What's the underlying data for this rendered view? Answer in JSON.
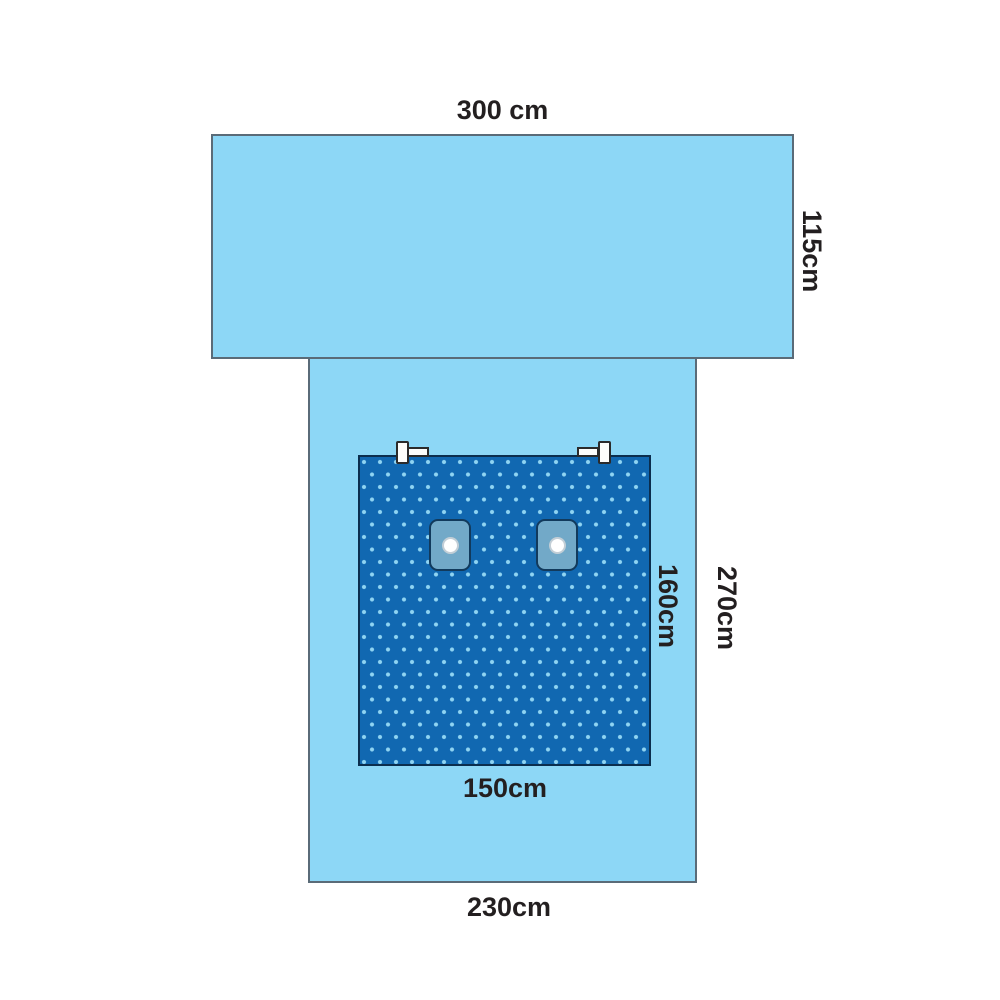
{
  "diagram": {
    "title": "Surgical drape dimension diagram",
    "dimensions": {
      "top_sheet_width": {
        "label": "300 cm"
      },
      "top_sheet_height": {
        "label": "115cm"
      },
      "body_sheet_height": {
        "label": "270cm"
      },
      "panel_height": {
        "label": "160cm"
      },
      "panel_width": {
        "label": "150cm"
      },
      "body_sheet_width": {
        "label": "230cm"
      }
    },
    "parts": {
      "top_sheet": "top cross sheet",
      "body_sheet": "vertical body sheet",
      "panel": "reinforced dotted panel",
      "patches": [
        "fenestration patch left",
        "fenestration patch right"
      ],
      "clips": [
        "tube holder clip left",
        "tube holder clip right"
      ]
    },
    "colors": {
      "drape_fill": "#8dd7f6",
      "drape_border": "#5a6b78",
      "panel_fill": "#1168b1",
      "panel_border": "#0b2e4e",
      "panel_dots": "#8fd4f2",
      "patch_fill": "#72a9c8",
      "patch_border": "#123a5c",
      "hole_fill": "#ffffff",
      "hole_ring": "#c2ced6",
      "clip_fill": "#fdfdfb",
      "clip_border": "#2b2b2b",
      "label_text": "#231f20",
      "page_bg": "#ffffff"
    }
  }
}
